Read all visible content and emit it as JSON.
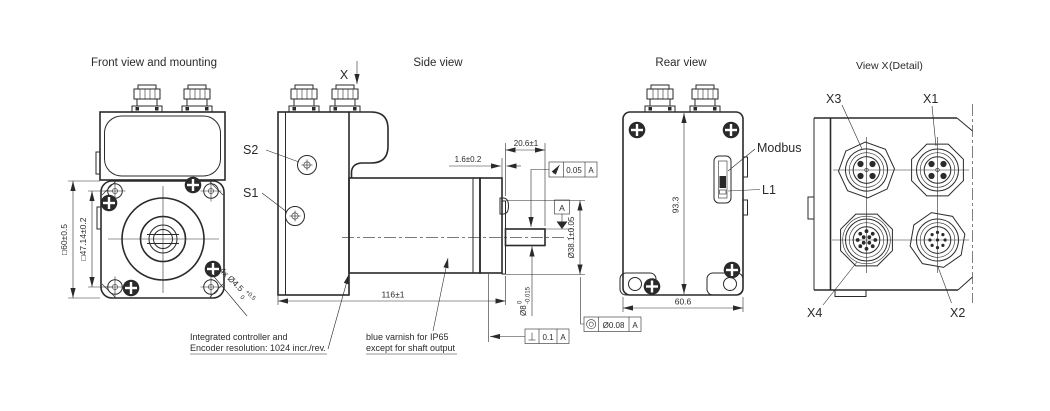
{
  "front_view": {
    "title": "Front view and mounting",
    "dim_body_square": "□60±0.5",
    "dim_hole_pattern": "□47.14±0.2",
    "holes_note_main": "4x Ø4.5",
    "holes_note_sup": "+0.5",
    "holes_note_sub": "0",
    "note_line1": "Integrated controller and",
    "note_line2": "Encoder resolution: 1024 incr./rev."
  },
  "side_view": {
    "title": "Side view",
    "detail_marker": "X",
    "screw_s2": "S2",
    "screw_s1": "S1",
    "dim_boss_height": "1.6±0.2",
    "dim_shaft_length": "20.6±1",
    "runout_tolerance": "0.05",
    "runout_datum": "A",
    "datum_label": "A",
    "dim_pilot_diameter": "Ø38.1±0.05",
    "shaft_dia_main": "Ø8",
    "shaft_dia_sup": "0",
    "shaft_dia_sub": "-0.015",
    "dim_overall_length": "116±1",
    "perpendicularity_tolerance": "0.1",
    "perpendicularity_datum": "A",
    "concentricity_tolerance": "Ø0.08",
    "concentricity_datum": "A",
    "varnish_note_line1": "blue varnish for IP65",
    "varnish_note_line2": "except for shaft output"
  },
  "rear_view": {
    "title": "Rear view",
    "dim_height": "93.3",
    "dim_width": "60.6",
    "label_modbus": "Modbus",
    "label_l1": "L1"
  },
  "view_x": {
    "title": "View X",
    "subtitle": "(Detail)",
    "label_x1": "X1",
    "label_x2": "X2",
    "label_x3": "X3",
    "label_x4": "X4"
  }
}
